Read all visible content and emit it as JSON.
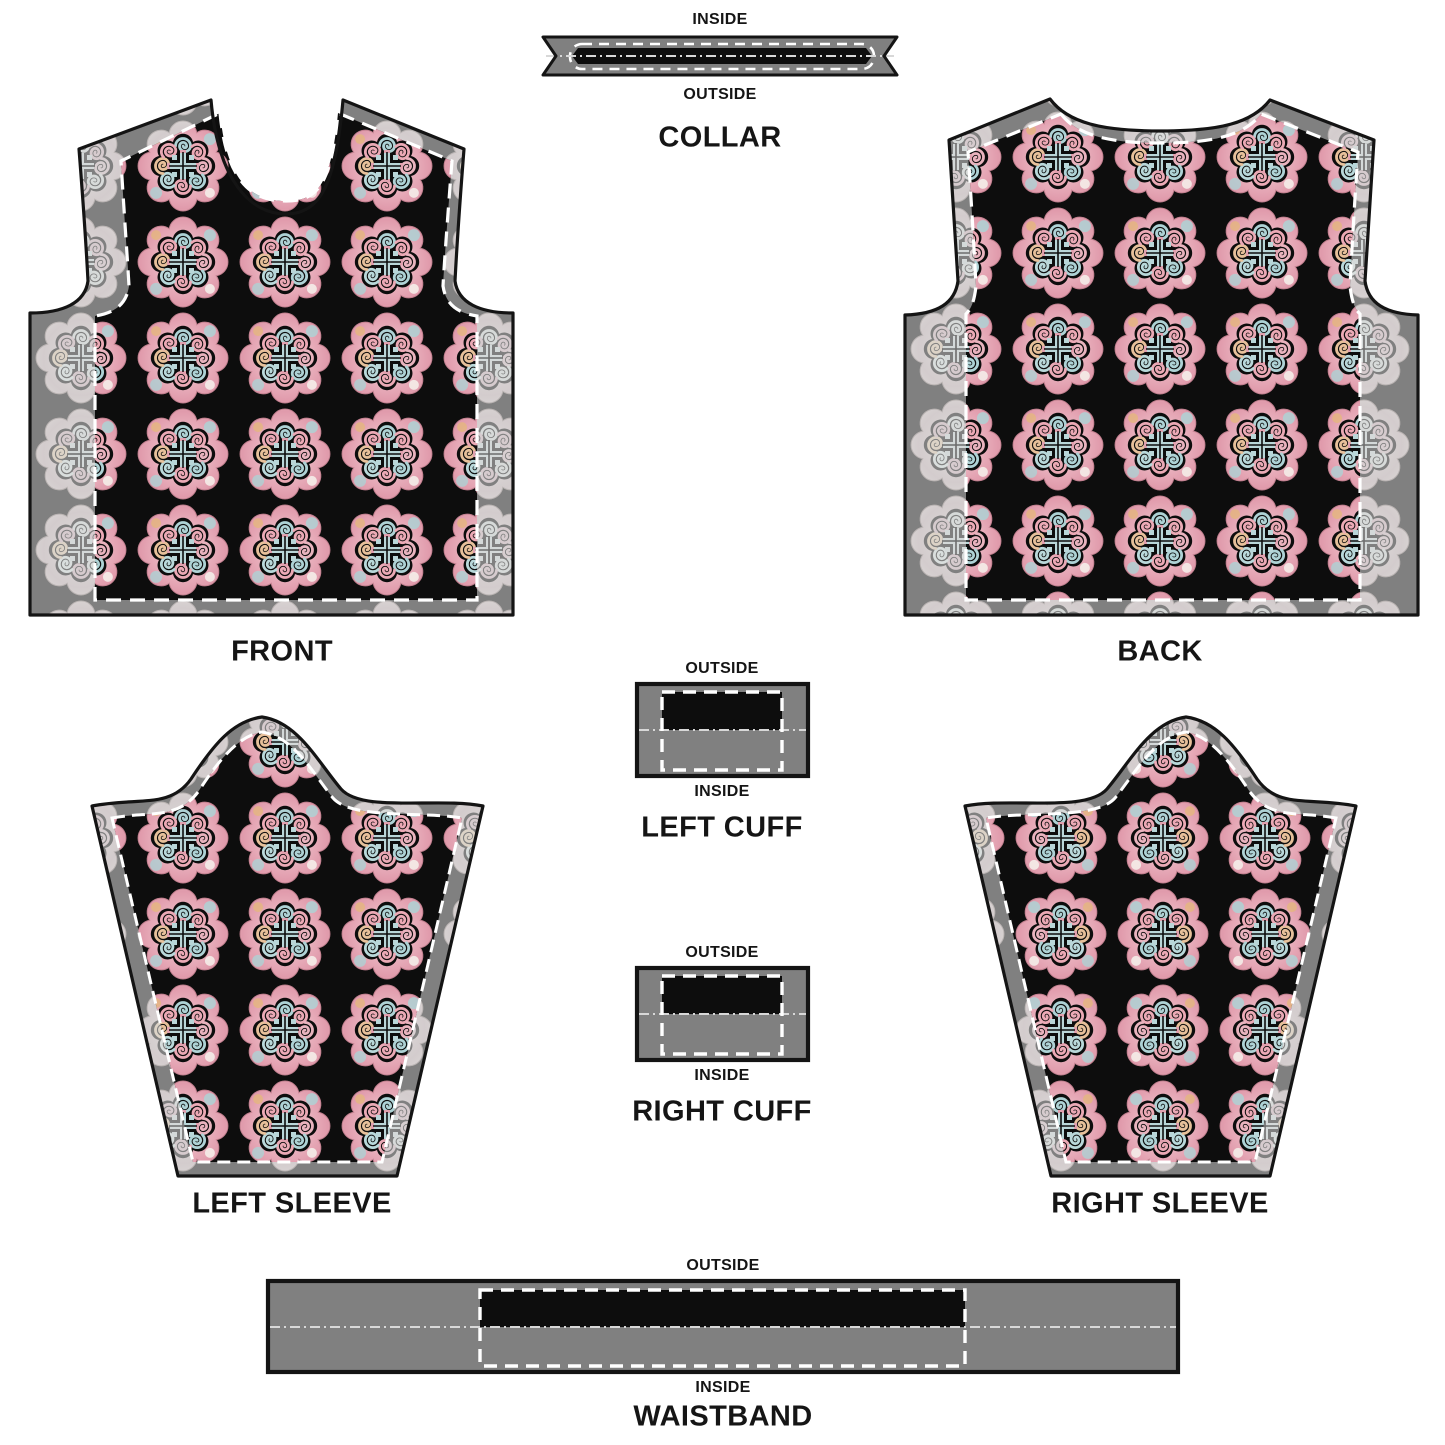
{
  "document_title": "Jacket sewing pattern mockup",
  "pieces": {
    "collar": {
      "label_inside": "INSIDE",
      "label_outside": "OUTSIDE",
      "title": "COLLAR"
    },
    "front": {
      "title": "FRONT"
    },
    "back": {
      "title": "BACK"
    },
    "left_cuff": {
      "label_outside": "OUTSIDE",
      "label_inside": "INSIDE",
      "title": "LEFT CUFF"
    },
    "right_cuff": {
      "label_outside": "OUTSIDE",
      "label_inside": "INSIDE",
      "title": "RIGHT CUFF"
    },
    "left_sleeve": {
      "title": "LEFT SLEEVE"
    },
    "right_sleeve": {
      "title": "RIGHT SLEEVE"
    },
    "waistband": {
      "label_outside": "OUTSIDE",
      "label_inside": "INSIDE",
      "title": "WAISTBAND"
    }
  },
  "colors": {
    "background": "#ffffff",
    "seam_allowance_gray": "#808080",
    "print_black": "#0d0d0d",
    "outline_black": "#141414",
    "seam_line_white": "#ffffff",
    "fold_line_gray": "#d8d8d8",
    "label_black": "#151515",
    "motif_pink": "#e8a9b6",
    "motif_blue": "#aed2d5",
    "motif_orange": "#e5b67e",
    "motif_cream": "#f3e4e2"
  }
}
